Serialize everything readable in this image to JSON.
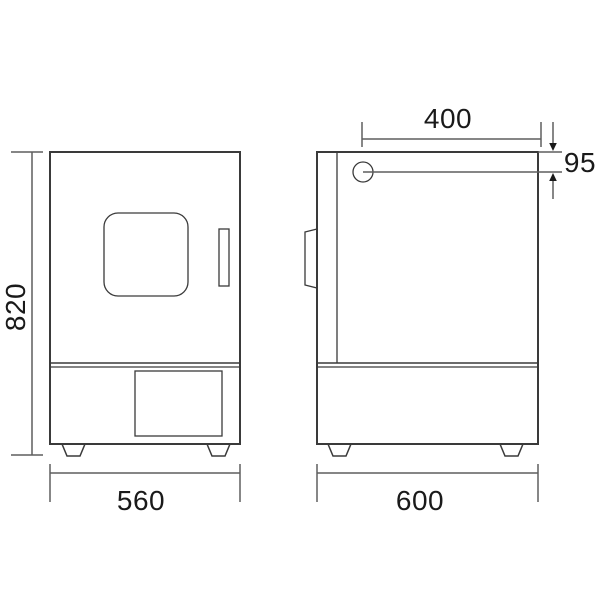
{
  "drawing": {
    "kind": "technical-dimension-drawing",
    "labels": {
      "height": "820",
      "width": "560",
      "depth": "600",
      "port_horizontal": "400",
      "port_vertical": "95"
    },
    "colors": {
      "background": "#ffffff",
      "body_fill": "#cdcdcd",
      "foot_fill": "#eaeaea",
      "handle_fill": "#d6d6d6",
      "outline": "#3a3a3a",
      "dimension_line": "#5f5f5f",
      "text": "#1a1a1a"
    }
  }
}
